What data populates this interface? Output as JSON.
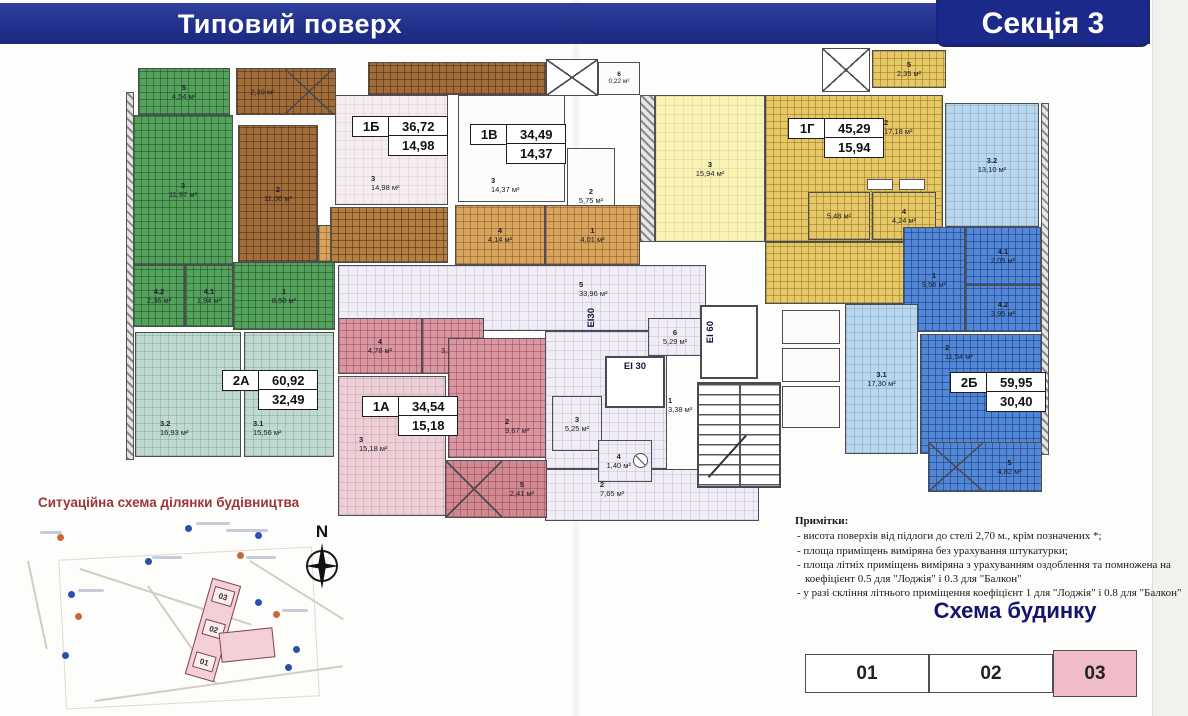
{
  "header": {
    "title": "Типовий поверх",
    "section": "Секція 3"
  },
  "apartments": {
    "a1b": {
      "code": "1Б",
      "total": "36,72",
      "living": "14,98"
    },
    "a1v": {
      "code": "1В",
      "total": "34,49",
      "living": "14,37"
    },
    "a1g": {
      "code": "1Г",
      "total": "45,29",
      "living": "15,94"
    },
    "a2a": {
      "code": "2А",
      "total": "60,92",
      "living": "32,49"
    },
    "a1a": {
      "code": "1А",
      "total": "34,54",
      "living": "15,18"
    },
    "a2b": {
      "code": "2Б",
      "total": "59,95",
      "living": "30,40"
    }
  },
  "rooms": {
    "g_balc": {
      "num": "5",
      "area": "4,54 м²"
    },
    "g_room3": {
      "num": "3",
      "area": "11,97 м²"
    },
    "g_room42": {
      "num": "4.2",
      "area": "2,36 м²"
    },
    "g_room41": {
      "num": "4.1",
      "area": "1,94 м²"
    },
    "g_room1": {
      "num": "1",
      "area": "8,50 м²"
    },
    "br_balc": {
      "num": "",
      "area": "2,39 м²"
    },
    "br_room2": {
      "num": "2",
      "area": "11,06 м²"
    },
    "or_room1": {
      "num": "1",
      "area": "4,20 м²"
    },
    "vent": {
      "num": "6",
      "area": "0,22 м²"
    },
    "b1b_r3": {
      "num": "3",
      "area": "14,98 м²"
    },
    "b1v_r3": {
      "num": "3",
      "area": "14,37 м²"
    },
    "b1v_r2": {
      "num": "2",
      "area": "5,75 м²"
    },
    "b1v_r4": {
      "num": "4",
      "area": "4,14 м²"
    },
    "b1v_r1": {
      "num": "1",
      "area": "4,01 м²"
    },
    "g1_r3": {
      "num": "3",
      "area": "15,94 м²"
    },
    "g1_r2": {
      "num": "2",
      "area": "17,18 м²"
    },
    "g1_bath": {
      "num": "",
      "area": "5,48 м²"
    },
    "g1_r4": {
      "num": "4",
      "area": "4,24 м²"
    },
    "g1_balc": {
      "num": "5",
      "area": "2,35 м²"
    },
    "b32": {
      "num": "3.2",
      "area": "13,10 м²"
    },
    "b41": {
      "num": "4.1",
      "area": "2,05 м²"
    },
    "b1": {
      "num": "1",
      "area": "9,56 м²"
    },
    "b42": {
      "num": "4.2",
      "area": "3,95 м²"
    },
    "b2": {
      "num": "2",
      "area": "11,54 м²"
    },
    "b31": {
      "num": "3.1",
      "area": "17,30 м²"
    },
    "b_balc": {
      "num": "5",
      "area": "4,82 м²"
    },
    "t32": {
      "num": "3.2",
      "area": "16,93 м²"
    },
    "t31": {
      "num": "3.1",
      "area": "15,56 м²"
    },
    "p_r4": {
      "num": "4",
      "area": "4,78 м²"
    },
    "p_r1": {
      "num": "1",
      "area": "3,20 м²"
    },
    "p_r3": {
      "num": "3",
      "area": "15,18 м²"
    },
    "p_r2": {
      "num": "2",
      "area": "9,67 м²"
    },
    "p_balc": {
      "num": "5",
      "area": "2,41 м²"
    },
    "c_corr": {
      "num": "5",
      "area": "33,96 м²"
    },
    "c6": {
      "num": "6",
      "area": "5,29 м²"
    },
    "c3": {
      "num": "3",
      "area": "5,25 м²"
    },
    "c4": {
      "num": "4",
      "area": "1,40 м²"
    },
    "c1": {
      "num": "1",
      "area": "3,38 м²"
    },
    "c2": {
      "num": "2",
      "area": "7,65 м²"
    }
  },
  "labels": {
    "ei30": "ЕІ 30",
    "ei60": "ЕІ 60",
    "ei30v": "ЕІ30"
  },
  "map": {
    "title": "Ситуаційна схема ділянки будівництва",
    "compass": "N",
    "sections": [
      "03",
      "02",
      "01"
    ]
  },
  "notes": {
    "title": "Примітки:",
    "items": [
      "висота поверхів від підлоги до стелі 2,70 м., крім позначених *;",
      "площа приміщень виміряна без урахування штукатурки;",
      "площа літніх приміщень виміряна з урахуванням оздоблення та помножена на коефіцієнт 0.5 для \"Лоджія\" і 0.3 для \"Балкон\"",
      "у разі скління літнього приміщення коефіцієнт 1 для \"Лоджія\" і 0.8 для \"Балкон\""
    ]
  },
  "scheme": {
    "title": "Схема будинку",
    "sections": [
      {
        "label": "01",
        "highlighted": false
      },
      {
        "label": "02",
        "highlighted": false
      },
      {
        "label": "03",
        "highlighted": true
      }
    ]
  },
  "colors": {
    "banner": "#222f8a",
    "scheme_highlight": "#f0bcc8",
    "map_title": "#9d3538"
  }
}
